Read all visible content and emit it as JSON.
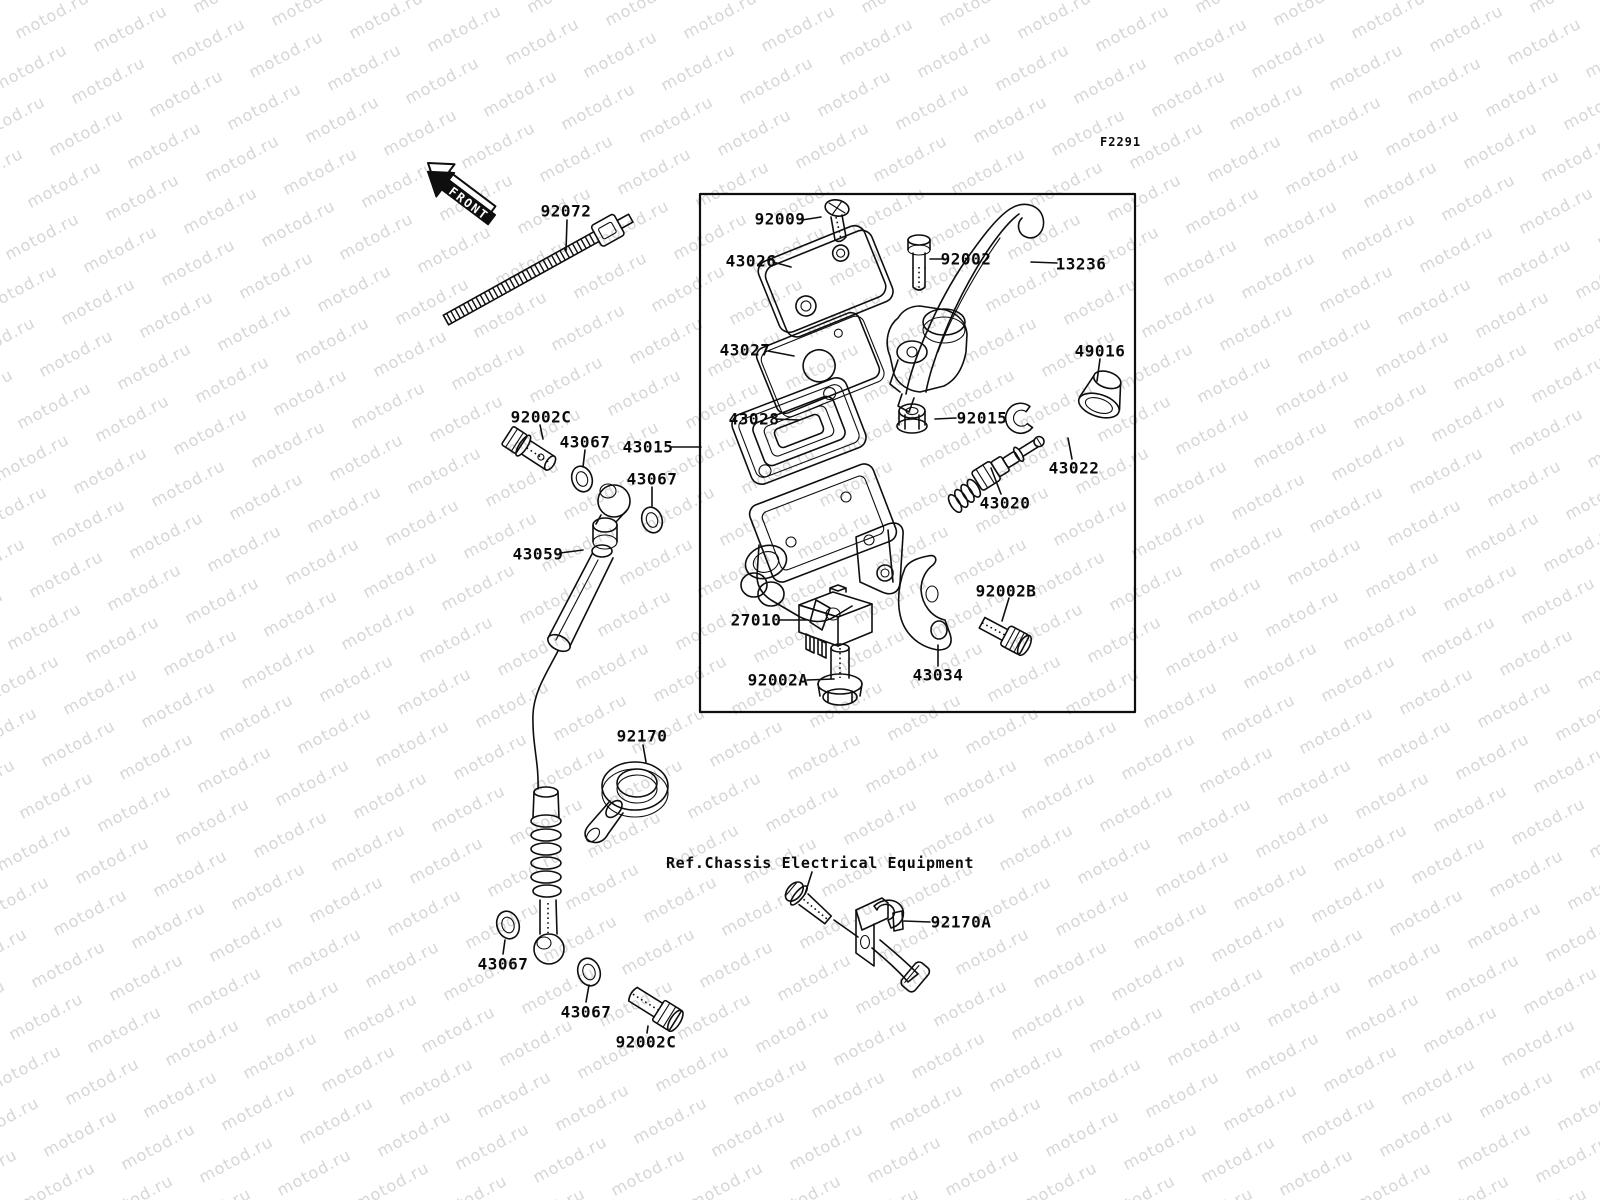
{
  "figure_code": "F2291",
  "front_label": "FRONT",
  "ref_note": "Ref.Chassis Electrical Equipment",
  "watermark": {
    "text": "motod.ru",
    "color": "#d6d6d6"
  },
  "part_labels": [
    {
      "text": "92072",
      "x": 566,
      "y": 211
    },
    {
      "text": "92009",
      "x": 780,
      "y": 219
    },
    {
      "text": "43026",
      "x": 751,
      "y": 261
    },
    {
      "text": "92002",
      "x": 966,
      "y": 259
    },
    {
      "text": "13236",
      "x": 1081,
      "y": 264
    },
    {
      "text": "43027",
      "x": 745,
      "y": 350
    },
    {
      "text": "49016",
      "x": 1100,
      "y": 351
    },
    {
      "text": "43028",
      "x": 754,
      "y": 419
    },
    {
      "text": "92015",
      "x": 982,
      "y": 418
    },
    {
      "text": "43022",
      "x": 1074,
      "y": 468
    },
    {
      "text": "43020",
      "x": 1005,
      "y": 503
    },
    {
      "text": "92002C",
      "x": 541,
      "y": 417
    },
    {
      "text": "43067",
      "x": 585,
      "y": 442
    },
    {
      "text": "43015",
      "x": 648,
      "y": 447
    },
    {
      "text": "43067",
      "x": 652,
      "y": 479
    },
    {
      "text": "43059",
      "x": 538,
      "y": 554
    },
    {
      "text": "27010",
      "x": 756,
      "y": 620
    },
    {
      "text": "92002A",
      "x": 778,
      "y": 680
    },
    {
      "text": "43034",
      "x": 938,
      "y": 675
    },
    {
      "text": "92002B",
      "x": 1006,
      "y": 591
    },
    {
      "text": "92170",
      "x": 642,
      "y": 736
    },
    {
      "text": "92170A",
      "x": 961,
      "y": 922
    },
    {
      "text": "43067",
      "x": 503,
      "y": 964
    },
    {
      "text": "43067",
      "x": 586,
      "y": 1012
    },
    {
      "text": "92002C",
      "x": 646,
      "y": 1042
    }
  ]
}
